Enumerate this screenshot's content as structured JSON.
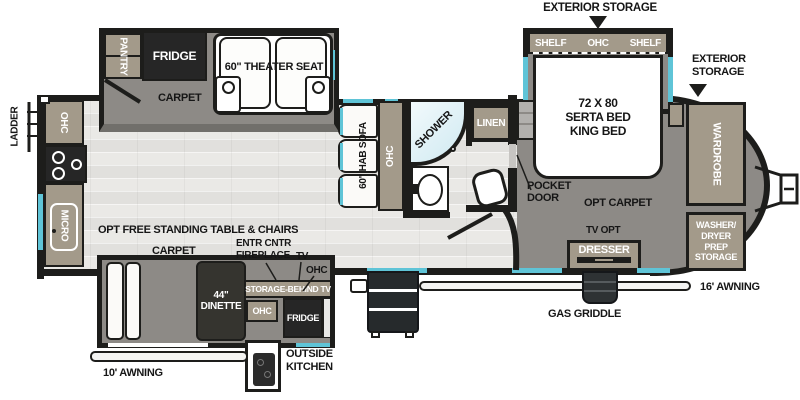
{
  "colors": {
    "wall": "#1d1d1b",
    "tan": "#a39a8a",
    "carpet": "#8d8a86",
    "floor": "#eae9e6",
    "window": "#5fc4d7",
    "appliance": "#262626"
  },
  "exterior": {
    "storage_top": "EXTERIOR STORAGE",
    "storage_right": "EXTERIOR STORAGE",
    "ladder": "LADDER",
    "awning_16": "16' AWNING",
    "awning_10": "10' AWNING",
    "gas_griddle": "GAS GRIDDLE",
    "outside_kitchen": "OUTSIDE KITCHEN"
  },
  "kitchen": {
    "ohc": "OHC",
    "micro": "MICRO",
    "pantry": "PANTRY",
    "fridge": "FRIDGE",
    "carpet": "CARPET"
  },
  "living": {
    "theater_seat": "60\" THEATER SEAT",
    "sofa": "60\" HAB SOFA",
    "sofa_ohc": "OHC",
    "opt_table": "OPT FREE STANDING TABLE & CHAIRS"
  },
  "bath": {
    "shower": "SHOWER",
    "linen": "LINEN",
    "pocket_door": "POCKET DOOR"
  },
  "bedroom": {
    "shelf_left": "SHELF",
    "ohc": "OHC",
    "shelf_right": "SHELF",
    "bed_line1": "72 X 80",
    "bed_line2": "SERTA BED",
    "bed_line3": "KING BED",
    "opt_carpet": "OPT CARPET",
    "tv_opt": "TV OPT",
    "dresser": "DRESSER",
    "wardrobe": "WARDROBE",
    "washer": "WASHER/ DRYER PREP STORAGE"
  },
  "dinette": {
    "label": "44\" DINETTE",
    "carpet": "CARPET",
    "entr_cntr": "ENTR CNTR FIREPLACE",
    "tv": "TV",
    "ohc": "OHC",
    "storage_behind_tv": "STORAGE-BEHIND TV",
    "ok_ohc": "OHC",
    "ok_fridge": "FRIDGE"
  }
}
